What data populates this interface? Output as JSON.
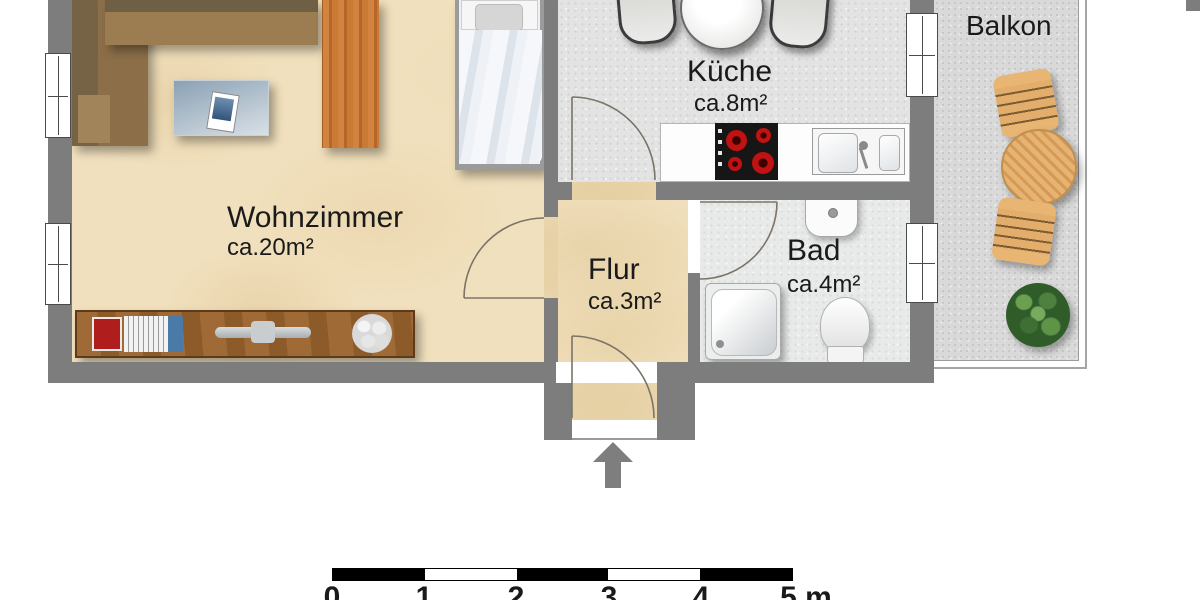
{
  "plan": {
    "rooms": {
      "wohnzimmer": {
        "label": "Wohnzimmer",
        "area": "ca.20m²",
        "furniture": [
          "corner-sofa",
          "coffee-table",
          "magazine",
          "wardrobe",
          "bed",
          "sideboard",
          "books",
          "decor-plant"
        ]
      },
      "kueche": {
        "label": "Küche",
        "area": "ca.8m²",
        "furniture": [
          "dining-table",
          "dining-chairs",
          "countertop",
          "cooktop",
          "sink"
        ]
      },
      "flur": {
        "label": "Flur",
        "area": "ca.3m²",
        "furniture": []
      },
      "bad": {
        "label": "Bad",
        "area": "ca.4m²",
        "furniture": [
          "washbasin",
          "shower",
          "toilet"
        ]
      },
      "balkon": {
        "label": "Balkon",
        "furniture": [
          "garden-table",
          "garden-chair",
          "garden-chair",
          "potted-plant"
        ]
      }
    },
    "entrance": {
      "symbol": "entrance-arrow"
    },
    "scale": {
      "labels": [
        "0",
        "1",
        "2",
        "3",
        "4"
      ],
      "last_label": "5 m"
    },
    "colors": {
      "wall": "#7d7d7d",
      "floor_beige": "#f1e0bd",
      "floor_gray": "#e3e3e3",
      "floor_balcony": "#d9d9d9",
      "sofa_brown": "#8a6e48",
      "wood_orange": "#c97b36",
      "sideboard_wood": "#9a6433",
      "burner_red": "#b51212",
      "arrow_gray": "#7e7e7e",
      "scalebar_black": "#000000"
    }
  }
}
